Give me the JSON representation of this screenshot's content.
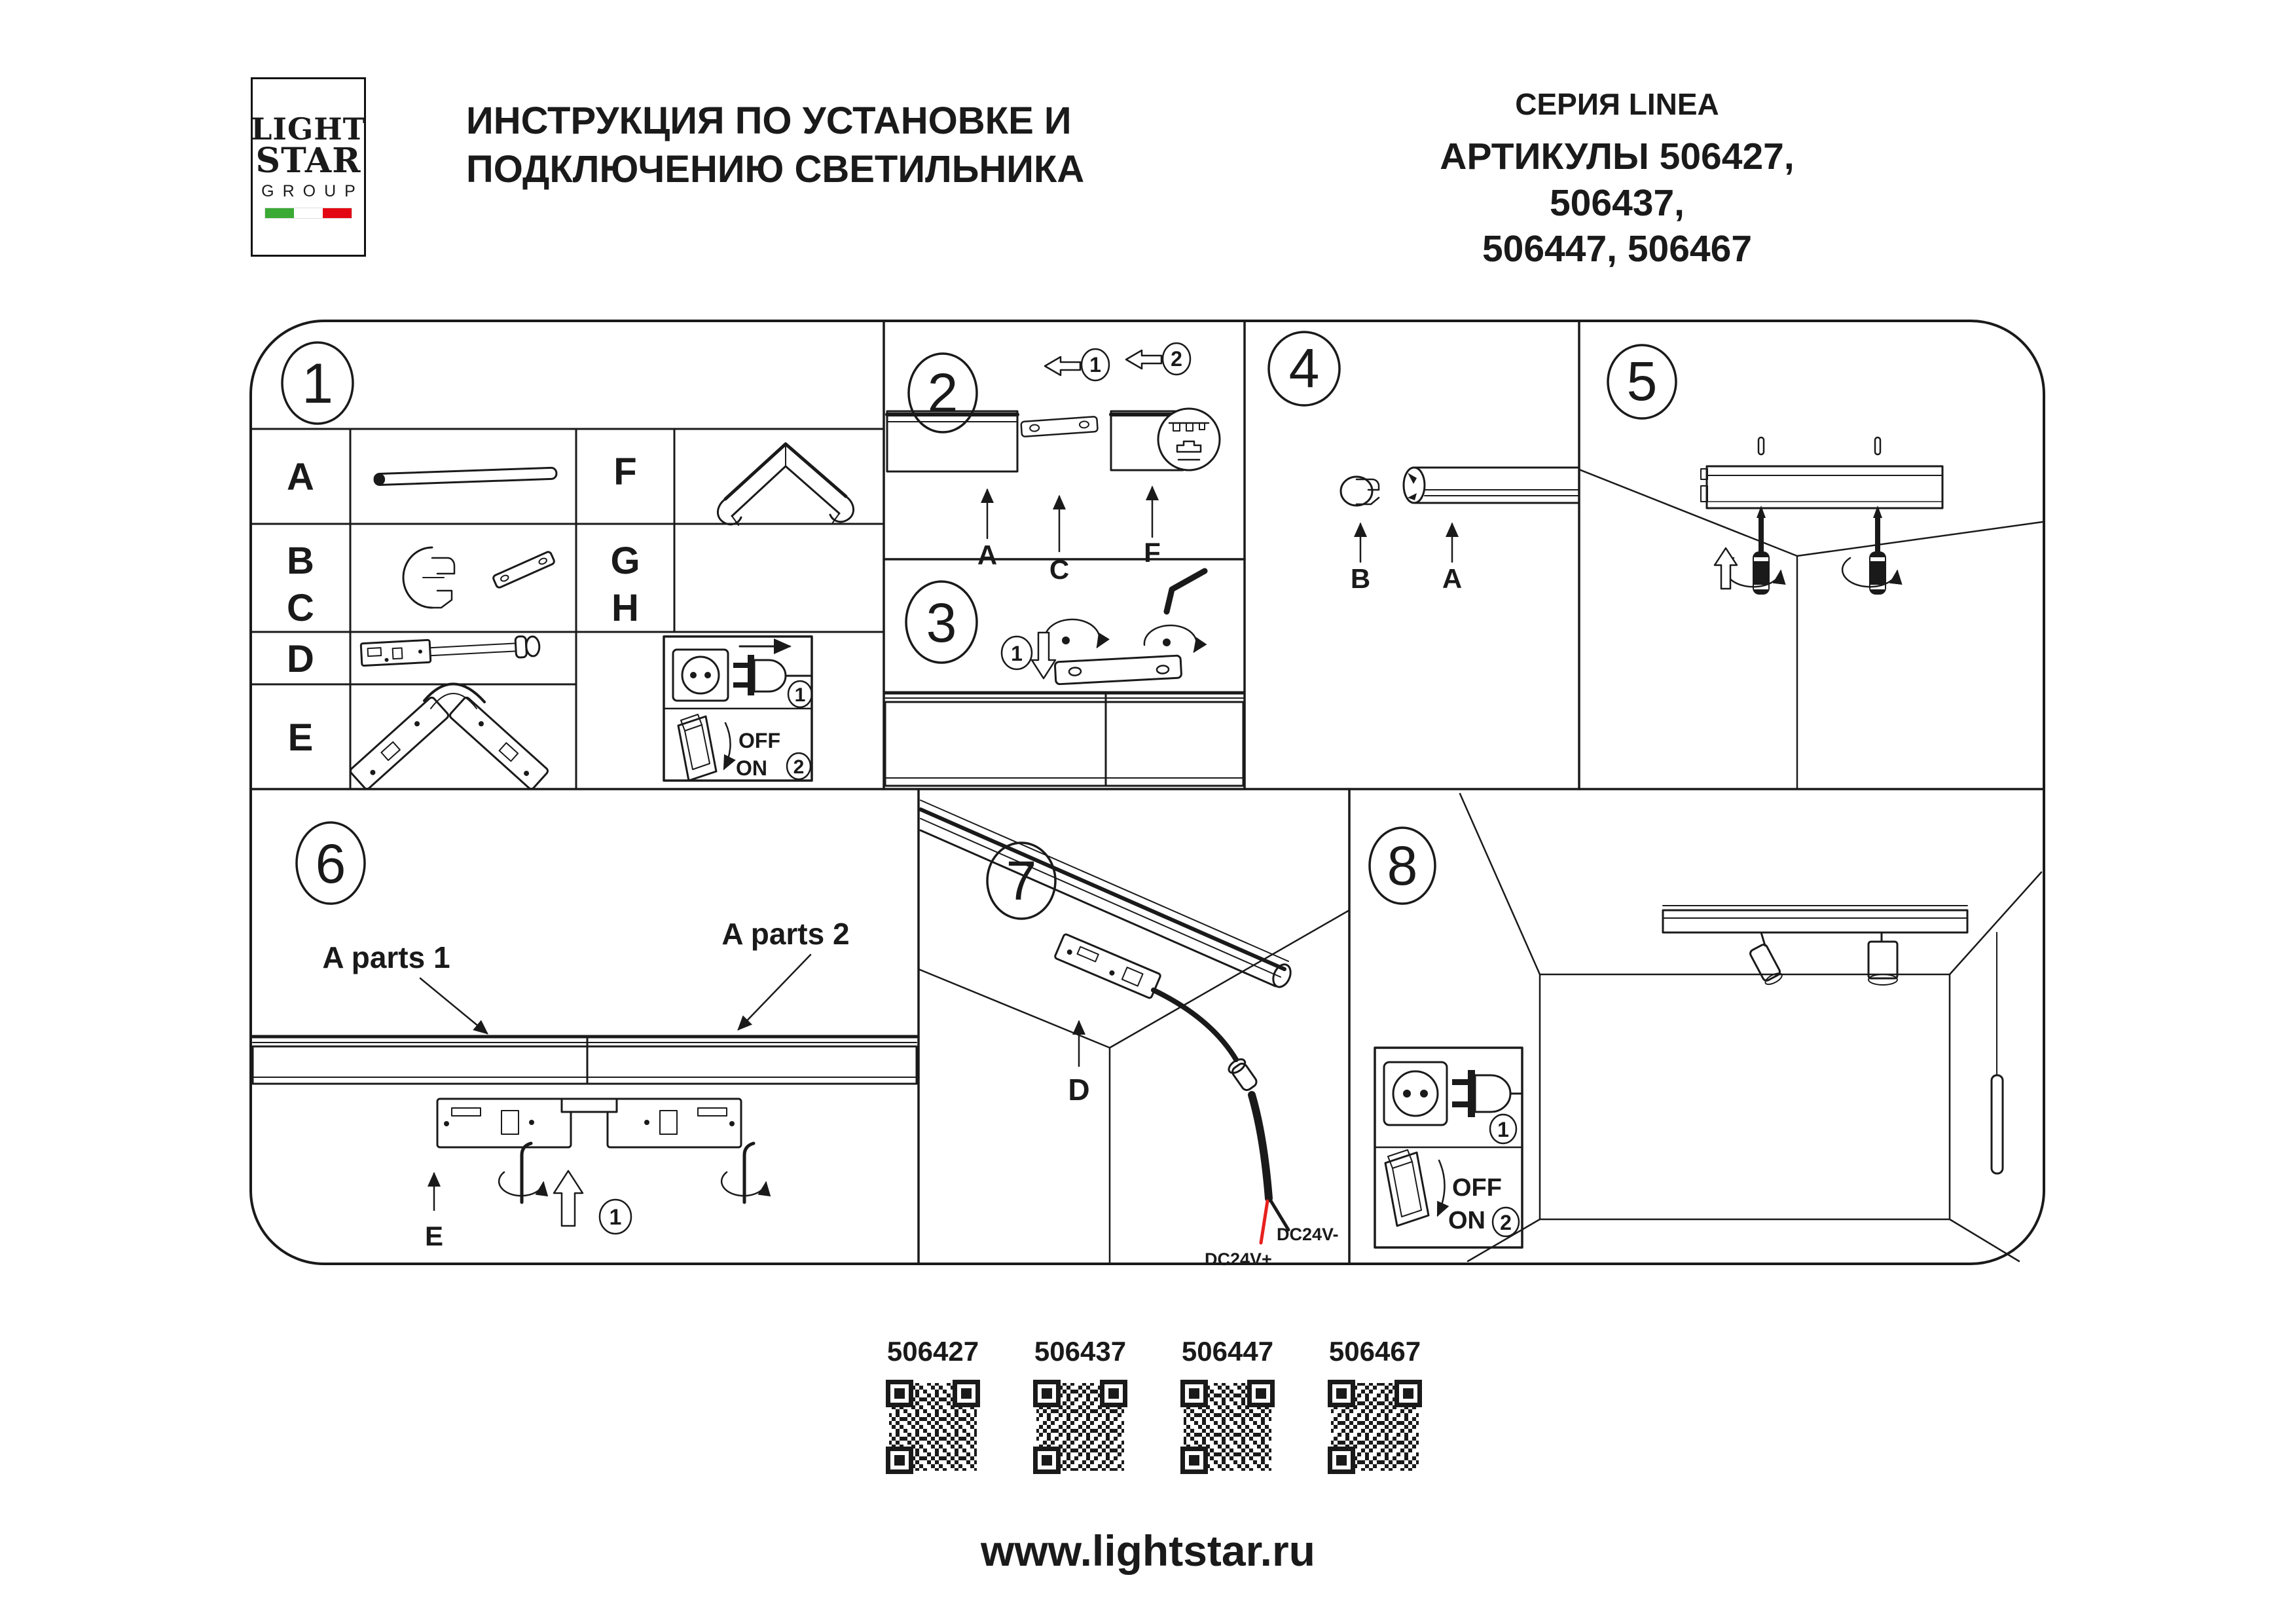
{
  "header": {
    "logo": {
      "line1": "LIGHT",
      "line2": "STAR",
      "line3": "GROUP"
    },
    "title": {
      "line1": "ИНСТРУКЦИЯ ПО УСТАНОВКЕ И",
      "line2": "ПОДКЛЮЧЕНИЮ СВЕТИЛЬНИКА"
    },
    "series": "СЕРИЯ LINEA",
    "articles": {
      "line1": "АРТИКУЛЫ 506427, 506437,",
      "line2": "506447, 506467"
    }
  },
  "power_box": {
    "step_plug": "1",
    "off_label": "OFF",
    "on_label": "ON",
    "step_switch": "2"
  },
  "panels": {
    "p1": {
      "number": "1",
      "row_a": "A",
      "row_b": "B",
      "row_c": "C",
      "row_d": "D",
      "row_e": "E",
      "col_f": "F",
      "col_g": "G",
      "col_h": "H"
    },
    "p2": {
      "number": "2",
      "step1": "1",
      "step2": "2",
      "label_a": "A",
      "label_c": "C",
      "label_f": "F"
    },
    "p3": {
      "number": "3",
      "step1": "1"
    },
    "p4": {
      "number": "4",
      "label_b": "B",
      "label_a": "A"
    },
    "p5": {
      "number": "5"
    },
    "p6": {
      "number": "6",
      "parts1": "A parts 1",
      "parts2": "A parts 2",
      "label_e": "E",
      "step1": "1"
    },
    "p7": {
      "number": "7",
      "label_d": "D",
      "dc_minus": "DC24V-",
      "dc_plus": "DC24V+"
    },
    "p8": {
      "number": "8"
    }
  },
  "qr": {
    "codes": [
      "506427",
      "506437",
      "506447",
      "506467"
    ]
  },
  "footer": {
    "website": "www.lightstar.ru"
  },
  "colors": {
    "ink": "#1a1a1a",
    "flag_green": "#3aaa35",
    "flag_red": "#e30613",
    "wire_red": "#e8211d"
  }
}
